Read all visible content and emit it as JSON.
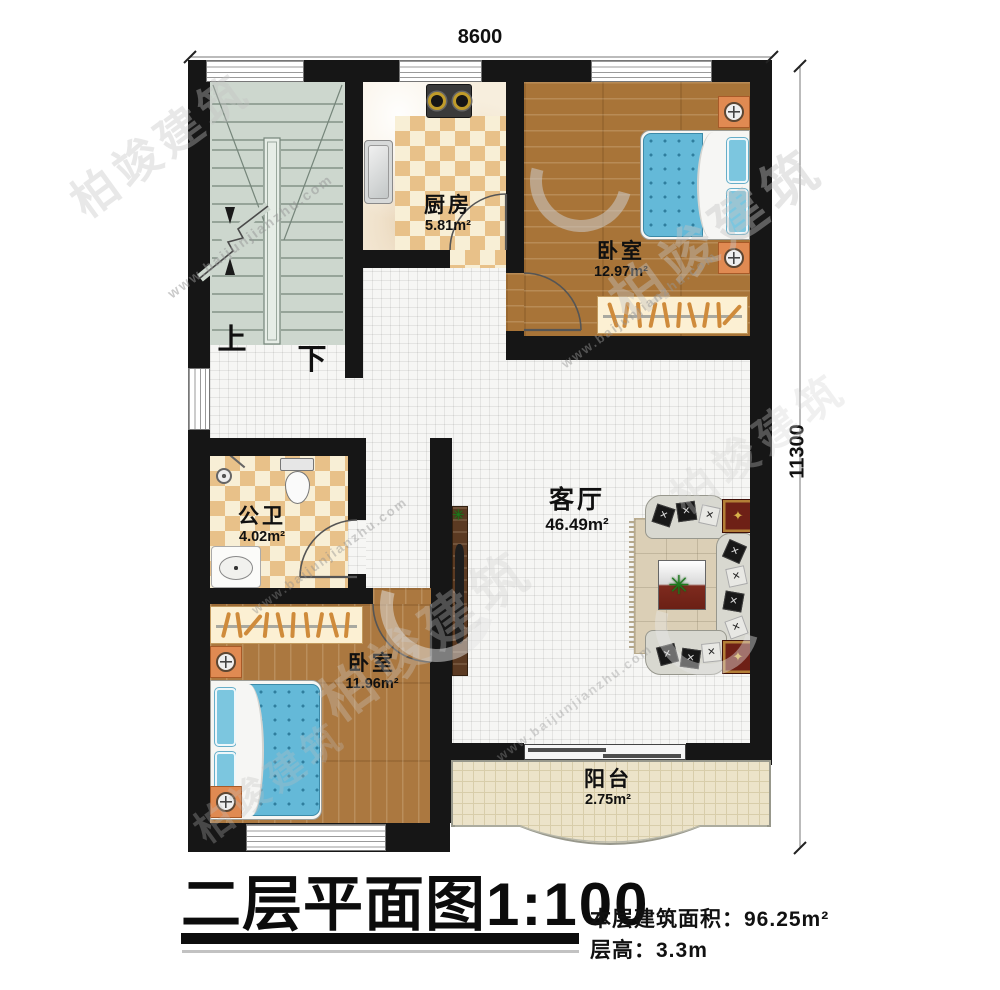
{
  "dimensions": {
    "width_label": "8600",
    "height_label": "11300"
  },
  "rooms": [
    {
      "id": "kitchen",
      "name": "厨房",
      "area": "5.81m²"
    },
    {
      "id": "bedroom-top",
      "name": "卧室",
      "area": "12.97m²"
    },
    {
      "id": "bathroom",
      "name": "公卫",
      "area": "4.02m²"
    },
    {
      "id": "living-room",
      "name": "客厅",
      "area": "46.49m²"
    },
    {
      "id": "bedroom-bottom",
      "name": "卧室",
      "area": "11.96m²"
    },
    {
      "id": "balcony",
      "name": "阳台",
      "area": "2.75m²"
    }
  ],
  "stairs": {
    "up_label": "上",
    "down_label": "下"
  },
  "title": {
    "main": "二层平面图",
    "scale": "1:100",
    "area_line": "本层建筑面积：96.25m²",
    "height_line": "层高：3.3m"
  },
  "watermark": {
    "url_text": "www.baijunjianzhu.com",
    "brand_text": "柏竣建筑"
  },
  "colors": {
    "wall": "#161616",
    "wood_floor": "#a87438",
    "stair_floor": "#cdd7ce",
    "tile_checker": "#e8c189",
    "bed_blue": "#64b9d8",
    "nightstand_orange": "#e08a52",
    "rug_beige": "#dbcfb6",
    "side_table_red": "#6e2016",
    "balcony_floor": "#ece3c9"
  }
}
